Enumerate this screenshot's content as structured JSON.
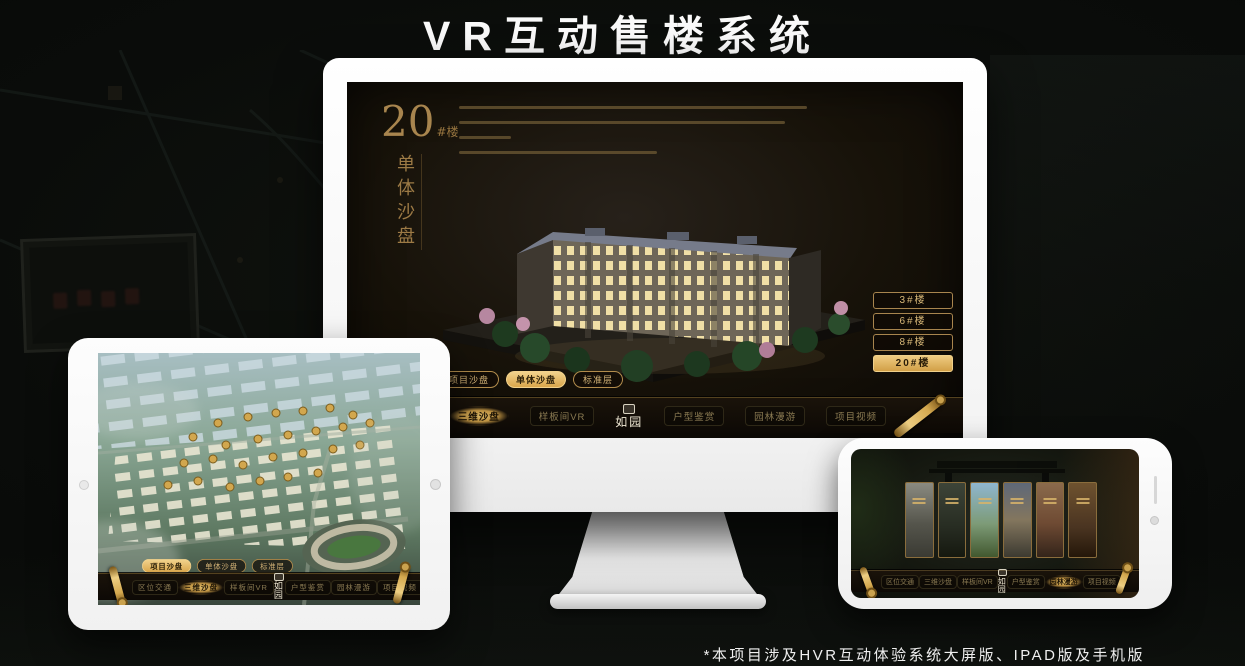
{
  "page": {
    "title": "VR互动售楼系统",
    "footnote": "*本项目涉及HVR互动体验系统大屏版、IPAD版及手机版"
  },
  "colors": {
    "gold_accent": "#c9a768",
    "gold_active": "#e2b56a",
    "screen_dark": "#171209",
    "bezel_white": "#fdfdfd"
  },
  "monitor": {
    "building_no": "20",
    "building_no_suffix": "#楼",
    "panel_title_vertical": "单体沙盘",
    "floor_buttons": [
      {
        "label": "3#楼",
        "active": false
      },
      {
        "label": "6#楼",
        "active": false
      },
      {
        "label": "8#楼",
        "active": false
      },
      {
        "label": "20#楼",
        "active": true
      }
    ],
    "subtabs": [
      {
        "label": "项目沙盘",
        "active": false
      },
      {
        "label": "单体沙盘",
        "active": true
      },
      {
        "label": "标准层",
        "active": false
      }
    ],
    "nav": {
      "logo": "如园",
      "items": [
        {
          "label": "区位交通",
          "active": false
        },
        {
          "label": "三维沙盘",
          "active": true
        },
        {
          "label": "样板间VR",
          "active": false
        },
        {
          "label": "户型鉴赏",
          "active": false
        },
        {
          "label": "园林漫游",
          "active": false
        },
        {
          "label": "项目视频",
          "active": false
        }
      ]
    }
  },
  "ipad": {
    "subtabs": [
      {
        "label": "项目沙盘",
        "active": true
      },
      {
        "label": "单体沙盘",
        "active": false
      },
      {
        "label": "标准层",
        "active": false
      }
    ],
    "nav": {
      "logo": "如园",
      "items": [
        {
          "label": "区位交通",
          "active": false
        },
        {
          "label": "三维沙盘",
          "active": true
        },
        {
          "label": "样板间VR",
          "active": false
        },
        {
          "label": "户型鉴赏",
          "active": false
        },
        {
          "label": "园林漫游",
          "active": false
        },
        {
          "label": "项目视频",
          "active": false
        }
      ]
    }
  },
  "phone": {
    "nav": {
      "logo": "如园",
      "items": [
        {
          "label": "区位交通",
          "active": false
        },
        {
          "label": "三维沙盘",
          "active": false
        },
        {
          "label": "样板间VR",
          "active": false
        },
        {
          "label": "户型鉴赏",
          "active": false
        },
        {
          "label": "园林漫游",
          "active": true
        },
        {
          "label": "项目视频",
          "active": false
        }
      ]
    }
  }
}
